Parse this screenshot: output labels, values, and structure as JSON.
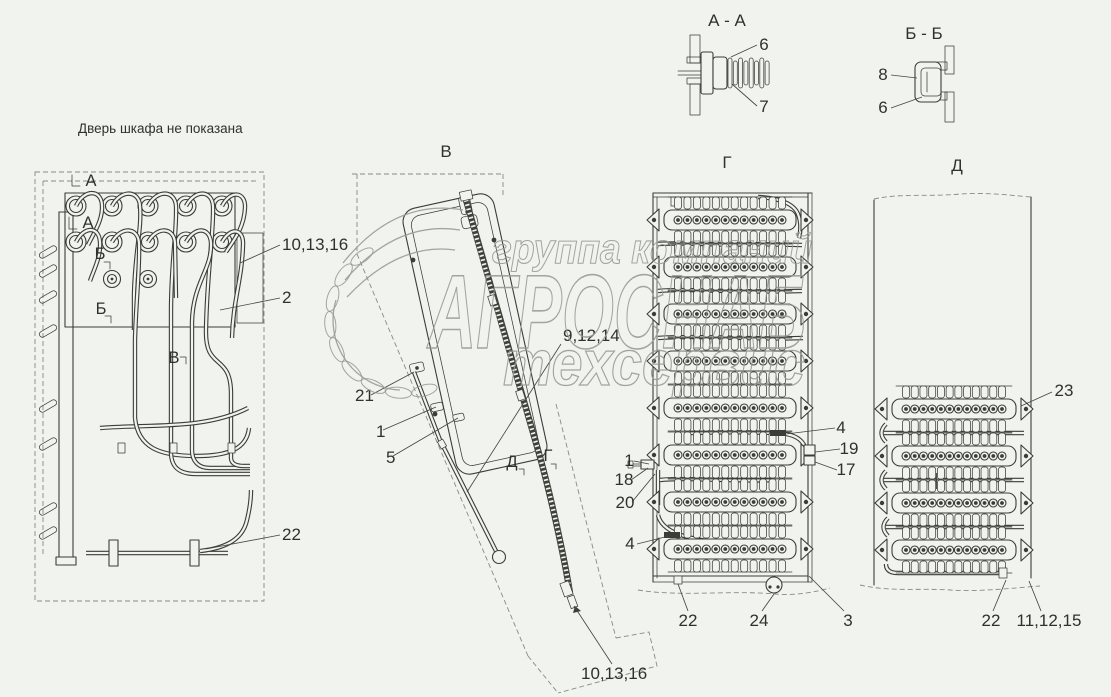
{
  "colors": {
    "background": "#f1f4ee",
    "line": "#3b3d39",
    "text": "#2f312d",
    "watermark": "#949c92"
  },
  "note": "Дверь шкафа не показана",
  "watermark": {
    "line1": "группа компаний",
    "line2": "АГРОСНАБ",
    "line3": "техсервис"
  },
  "section_aa": {
    "title": "А - А",
    "callout_6": "6",
    "callout_7": "7"
  },
  "section_bb": {
    "title": "Б - Б",
    "callout_8": "8",
    "callout_6": "6"
  },
  "cabinet": {
    "marker_a_top": "А",
    "marker_a_mid": "А",
    "marker_b_top": "Б",
    "marker_b_bottom": "Б",
    "marker_v": "В",
    "callout_10_13_16": "10,13,16",
    "callout_2": "2",
    "callout_22": "22"
  },
  "view_v": {
    "title": "В",
    "callout_9_12_14": "9,12,14",
    "callout_21": "21",
    "callout_1": "1",
    "callout_5": "5",
    "marker_d": "Д",
    "marker_g": "Г",
    "callout_10_13_16": "10,13,16"
  },
  "view_g": {
    "title": "Г",
    "callout_4_top": "4",
    "callout_19": "19",
    "callout_17": "17",
    "callout_1": "1",
    "callout_18": "18",
    "callout_20": "20",
    "callout_4_bottom": "4",
    "callout_22": "22",
    "callout_24": "24",
    "callout_3": "3"
  },
  "view_d": {
    "title": "Д",
    "callout_23": "23",
    "callout_22": "22",
    "callout_11_12_15": "11,12,15"
  }
}
